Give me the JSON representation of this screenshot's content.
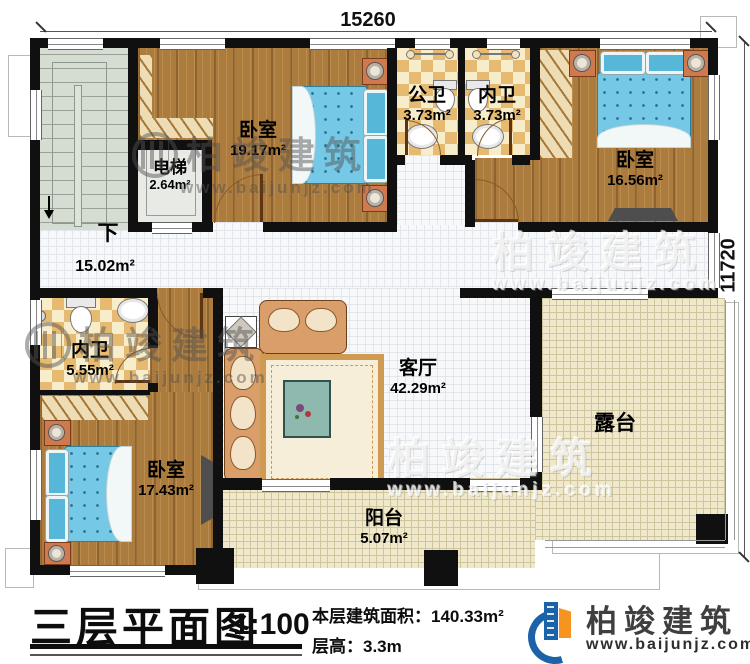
{
  "dimensions": {
    "top": "15260",
    "right": "11720"
  },
  "labels": {
    "down": "下"
  },
  "rooms": {
    "bedroom1": {
      "name": "卧室",
      "area": "19.17m²"
    },
    "elevator": {
      "name": "电梯",
      "area": "2.64m²"
    },
    "public_bath": {
      "name": "公卫",
      "area": "3.73m²"
    },
    "ensuite_top": {
      "name": "内卫",
      "area": "3.73m²"
    },
    "bedroom2": {
      "name": "卧室",
      "area": "16.56m²"
    },
    "hall": {
      "area": "15.02m²"
    },
    "ensuite_left": {
      "name": "内卫",
      "area": "5.55m²"
    },
    "bedroom3": {
      "name": "卧室",
      "area": "17.43m²"
    },
    "living": {
      "name": "客厅",
      "area": "42.29m²"
    },
    "terrace": {
      "name": "露台"
    },
    "balcony": {
      "name": "阳台",
      "area": "5.07m²"
    }
  },
  "title_block": {
    "title": "三层平面图",
    "scale": "1:100",
    "area_info": "本层建筑面积：140.33m²",
    "height_info": "层高：3.3m"
  },
  "brand": {
    "name": "柏竣建筑",
    "website": "www.baijunjz.com"
  },
  "watermark": {
    "name": "柏竣建筑",
    "website": "www.baijunjz.com"
  },
  "colors": {
    "wall": "#101010",
    "wood": "#ab7c3e",
    "tile": "#f7f8fa",
    "checker": "#e6ba70",
    "terrace": "#efe8cb",
    "bed_blue": "#76c9e6",
    "brand_blue": "#1b62a8",
    "brand_orange": "#f7941f"
  }
}
